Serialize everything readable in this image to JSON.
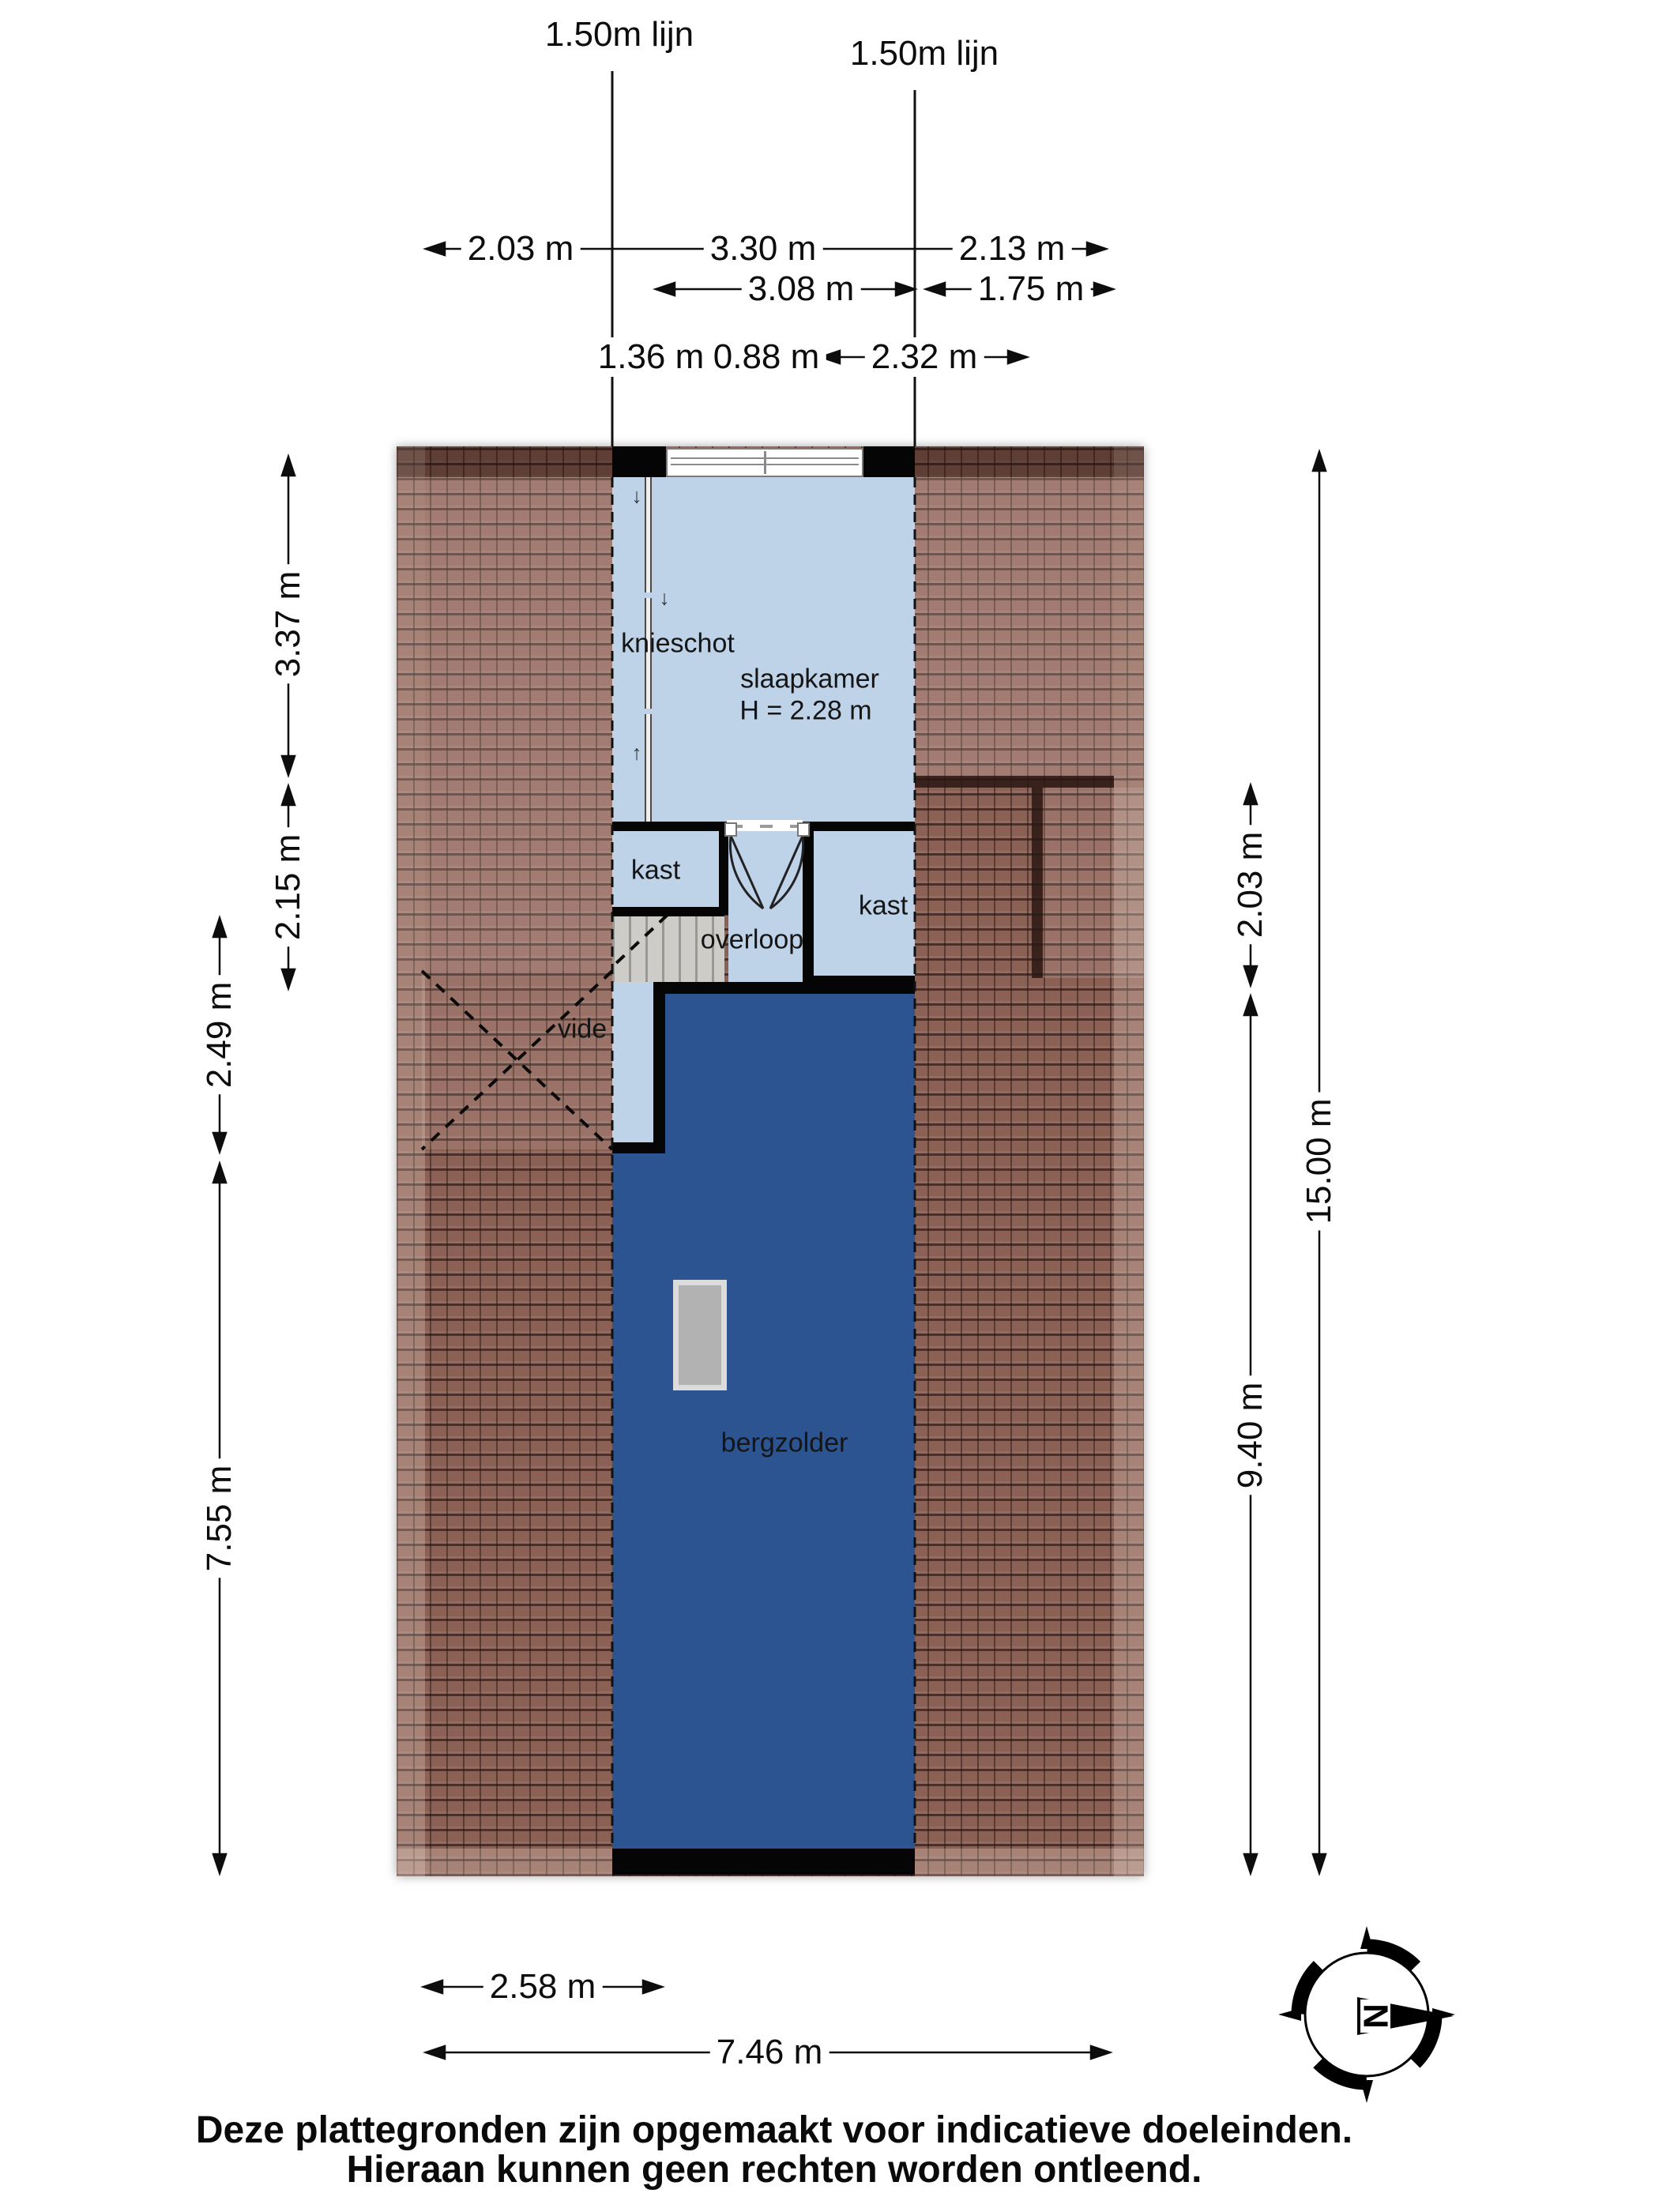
{
  "roof_lines": {
    "left": "1.50m lijn",
    "right": "1.50m lijn"
  },
  "dims": {
    "top_row1": [
      "2.03 m",
      "3.30 m",
      "2.13 m"
    ],
    "top_row2": [
      "3.08 m",
      "1.75 m"
    ],
    "top_row3": [
      "1.36 m",
      "0.88 m",
      "2.32 m"
    ],
    "left": [
      "3.37 m",
      "2.15 m",
      "2.49 m",
      "7.55 m"
    ],
    "right": [
      "2.03 m",
      "9.40 m",
      "15.00 m"
    ],
    "bottom": [
      "2.58 m",
      "7.46 m"
    ]
  },
  "rooms": {
    "knieschot": "knieschot",
    "slaapkamer": "slaapkamer",
    "slaapkamer_height": "H = 2.28 m",
    "kast_left": "kast",
    "kast_right": "kast",
    "overloop": "overloop",
    "vide": "vide",
    "bergzolder": "bergzolder"
  },
  "arrows": {
    "down": "↓",
    "up": "↑"
  },
  "compass": {
    "north": "N"
  },
  "footer": {
    "line1": "Deze plattegronden zijn opgemaakt voor indicatieve doeleinden.",
    "line2": "Hieraan kunnen geen rechten worden ontleend."
  },
  "colors": {
    "room_light": "#bed3e8",
    "room_dark": "#2b5491",
    "roof": "#8b6055",
    "wall": "#050505"
  }
}
